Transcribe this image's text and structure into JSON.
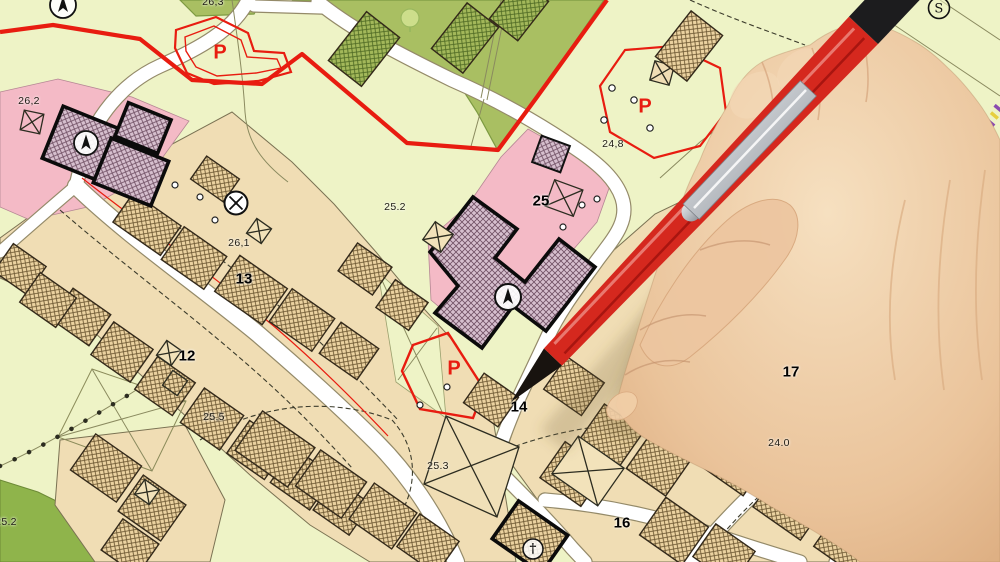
{
  "labels": {
    "p13": "13",
    "p12": "12",
    "p25": "25",
    "p14": "14",
    "p16": "16",
    "p17": "17",
    "e26_3": "26,3",
    "e26_2": "26,2",
    "e26_1": "26,1",
    "e25_2": "25.2",
    "e25_5": "25,5",
    "e25_2b": "25.2",
    "e25_3": "25.3",
    "e24_8": "24,8",
    "e24_0": "24.0",
    "p_parking_nw": "P",
    "p_parking_ne": "P",
    "p_parking_c": "P",
    "s_marker": "S",
    "church_cross": "†"
  },
  "icons": {
    "north_arrow": "north-arrow compass, circled, appears 3 times",
    "survey_point": "circled X survey point",
    "church": "circled cross",
    "tree": "tree symbol"
  },
  "colors": {
    "pale-green": "#eef3c6",
    "mid-green": "#a9bf62",
    "dark-green": "#8fb44b",
    "tan": "#f0ddb4",
    "tan-light": "#f2e2ba",
    "pink": "#f4bac6",
    "road": "#ffffff",
    "red": "#e81c10",
    "pencil-red": "#d5281e",
    "skin": "#e9c49f"
  }
}
